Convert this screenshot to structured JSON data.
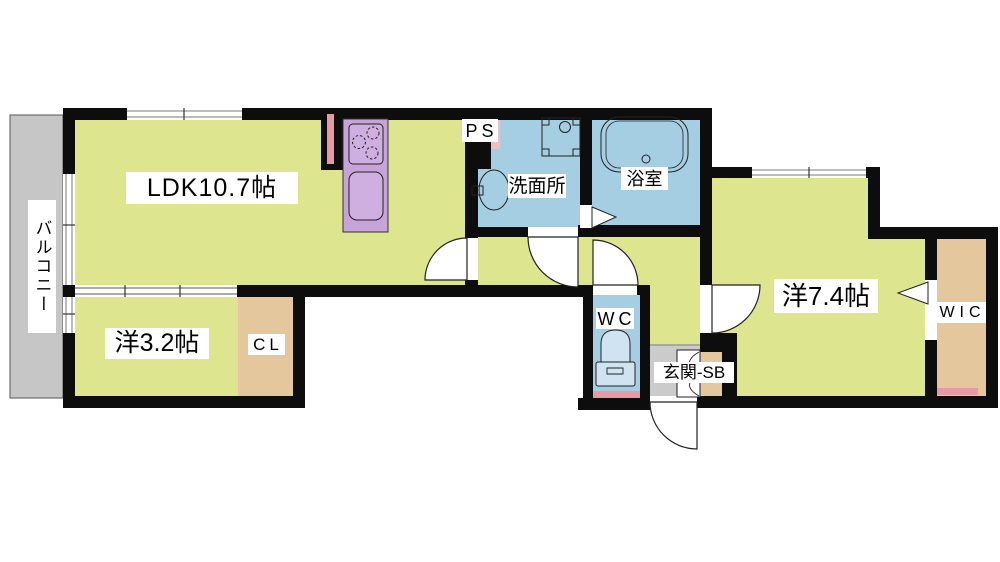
{
  "plan": {
    "type": "apartment-floorplan",
    "rooms": {
      "balcony": {
        "label": "バルコニー"
      },
      "ldk": {
        "label": "LDK10.7帖"
      },
      "western_small": {
        "label": "洋3.2帖"
      },
      "closet": {
        "label": "CL"
      },
      "pipe_space": {
        "label": "PS"
      },
      "washroom": {
        "label": "洗面所"
      },
      "bathroom": {
        "label": "浴室"
      },
      "toilet_room": {
        "label": "WC"
      },
      "entrance": {
        "label": "玄関-SB"
      },
      "western_large": {
        "label": "洋7.4帖"
      },
      "walk_in_closet": {
        "label": "WIC"
      }
    },
    "colors": {
      "room_yellow": "#dde58f",
      "wet_area_blue": "#a5cee2",
      "closet_tan": "#e5c79e",
      "kitchen_purple": "#c7a3da",
      "balcony_gray": "#c6c6c6",
      "entrance_gray": "#cbcbcb",
      "accent_pink": "#e89aa4",
      "ps_pink": "#f3bdc6",
      "wall_black": "#0d0d0d"
    },
    "fixture_icons": [
      "kitchen-counter-icon",
      "gas-stove-icon",
      "kitchen-sink-icon",
      "washer-pan-icon",
      "wash-basin-icon",
      "bathtub-icon",
      "toilet-icon",
      "door-swing-icon",
      "folding-door-icon",
      "sliding-window-icon",
      "bifold-shoebox-door-icon"
    ]
  }
}
